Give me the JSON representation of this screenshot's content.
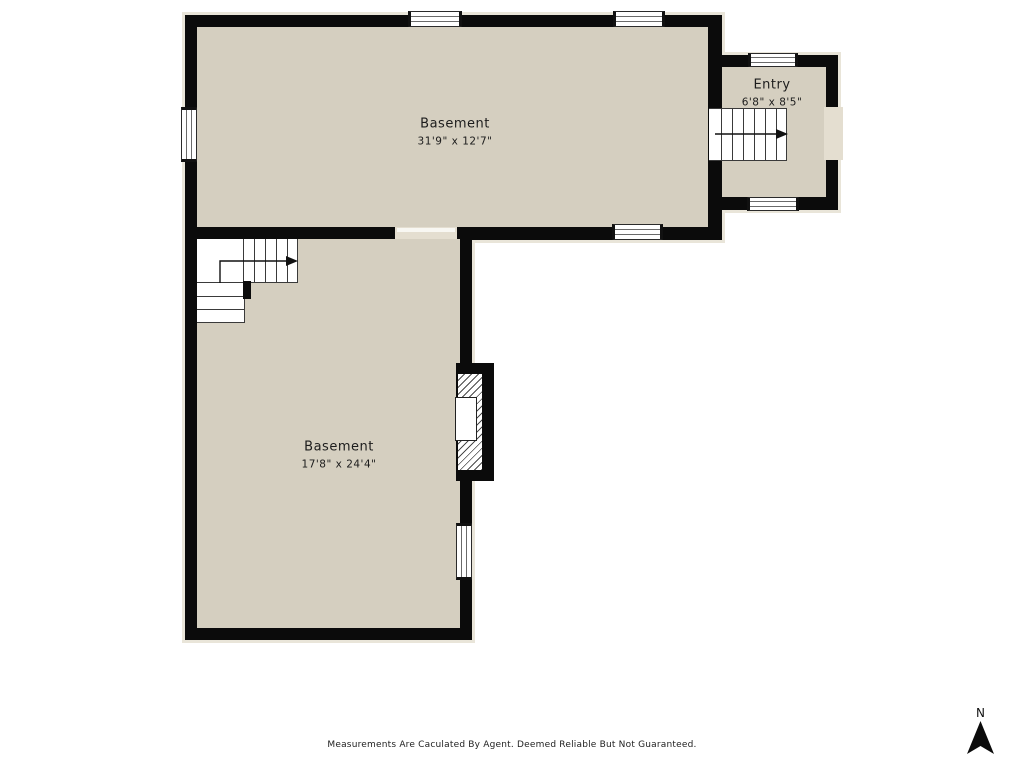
{
  "plan": {
    "type": "basement-floor-plan",
    "colors": {
      "wall": "#0b0b0b",
      "floor": "#d5cfc0",
      "halo": "#e9e5d9",
      "door_gap": "#e4ded0",
      "background": "#ffffff"
    }
  },
  "rooms": [
    {
      "id": "basement-upper",
      "name": "Basement",
      "dimensions": "31'9\" x 12'7\""
    },
    {
      "id": "basement-lower",
      "name": "Basement",
      "dimensions": "17'8\" x 24'4\""
    },
    {
      "id": "entry",
      "name": "Entry",
      "dimensions": "6'8\" x 8'5\""
    }
  ],
  "compass": {
    "label": "N"
  },
  "footer": {
    "disclaimer": "Measurements Are Caculated By Agent. Deemed Reliable But Not Guaranteed."
  }
}
